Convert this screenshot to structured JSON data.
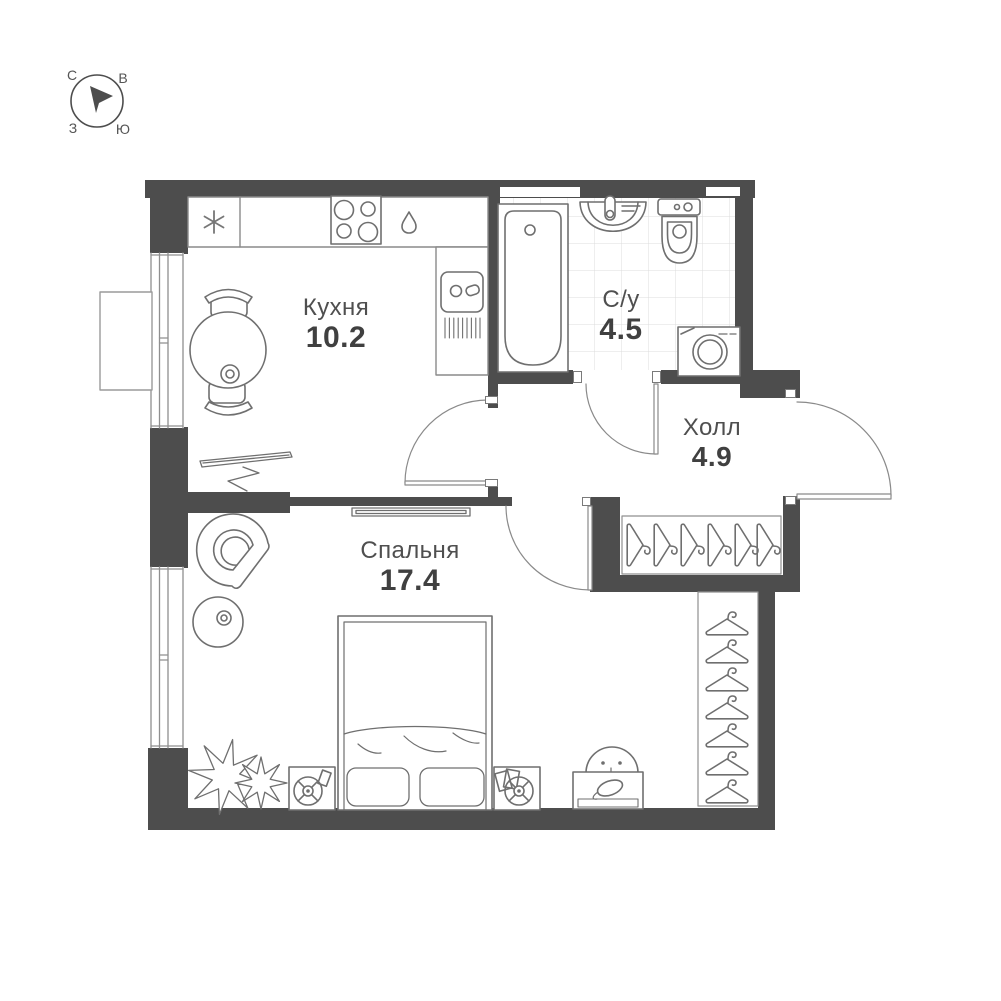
{
  "compass": {
    "north": "С",
    "east": "В",
    "west": "З",
    "south": "Ю"
  },
  "rooms": {
    "kitchen": {
      "label": "Кухня",
      "area": "10.2"
    },
    "bathroom": {
      "label": "С/у",
      "area": "4.5"
    },
    "hall": {
      "label": "Холл",
      "area": "4.9"
    },
    "bedroom": {
      "label": "Спальня",
      "area": "17.4"
    }
  },
  "icons": {
    "fridge": "snowflake-icon",
    "stove": "stove-burners-icon",
    "water": "droplet-icon",
    "hangers": "hanger-icon"
  },
  "colors": {
    "wall": "#4d4d4d",
    "furniture_stroke": "#6f6f6f",
    "tile_line": "#dcdcdc",
    "label_text": "#4f4f4f",
    "area_text": "#404040"
  }
}
